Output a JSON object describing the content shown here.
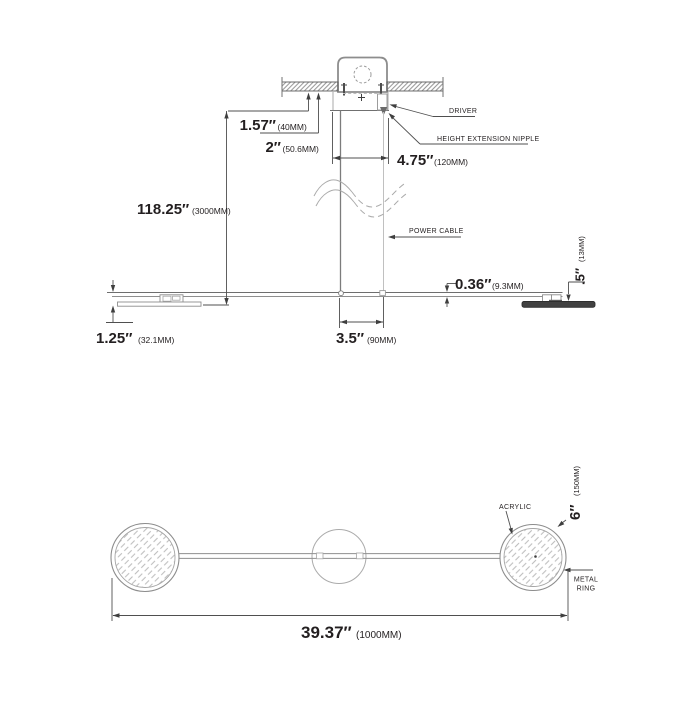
{
  "colors": {
    "ink": "#231f20",
    "drawing_line": "#707070",
    "dim_line": "#4f4f4f",
    "light_line": "#a8a8a8",
    "disk_fill": "#414141",
    "hatch": "#858585"
  },
  "side_view": {
    "callouts": {
      "driver": "DRIVER",
      "height_extension_nipple": "HEIGHT EXTENSION NIPPLE",
      "power_cable": "POWER CABLE"
    },
    "dims": {
      "canopy_offset": {
        "value": "1.57″",
        "paren": "(40MM)"
      },
      "canopy_depth": {
        "value": "2″",
        "paren": "(50.6MM)"
      },
      "canopy_width": {
        "value": "4.75″",
        "paren": "(120MM)"
      },
      "max_drop": {
        "value": "118.25″",
        "paren": "(3000MM)"
      },
      "bar_thickness": {
        "value": "0.36″",
        "paren": "(9.3MM)"
      },
      "disk_thickness": {
        "value": ".5″",
        "paren": "(13MM)"
      },
      "end_drop": {
        "value": "1.25″",
        "paren": "(32.1MM)"
      },
      "cable_spacing": {
        "value": "3.5″",
        "paren": "(90MM)"
      }
    }
  },
  "plan_view": {
    "callouts": {
      "acrylic": "ACRYLIC",
      "metal_ring_line1": "METAL",
      "metal_ring_line2": "RING"
    },
    "dims": {
      "overall_length": {
        "value": "39.37″",
        "paren": "(1000MM)"
      },
      "disk_diameter": {
        "value": "6″",
        "paren": "(150MM)"
      }
    }
  }
}
